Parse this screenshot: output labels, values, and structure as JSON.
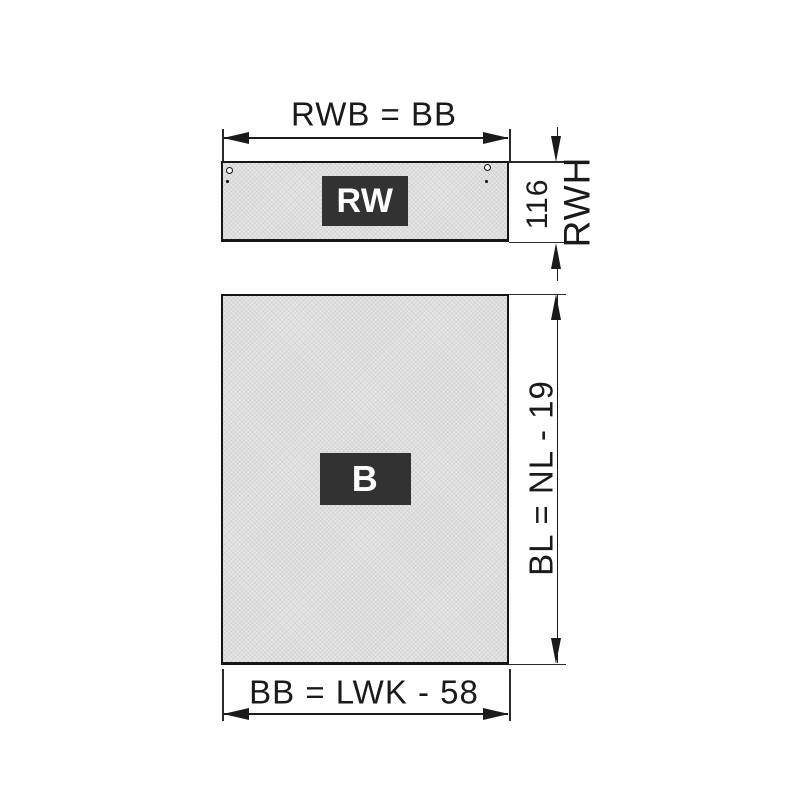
{
  "panels": {
    "rear_wall": {
      "label": "RW"
    },
    "bottom_panel": {
      "label": "B"
    }
  },
  "dimensions": {
    "top_width": {
      "label": "RWB = BB"
    },
    "rear_wall_height": {
      "value": "116",
      "label": "RWH"
    },
    "bottom_length": {
      "label": "BL = NL - 19"
    },
    "bottom_width": {
      "label": "BB = LWK - 58"
    }
  },
  "colors": {
    "background": "#ffffff",
    "line": "#1a1a1a",
    "panel_fill": "#e6e6e6",
    "panel_border": "#161616",
    "label_box_bg": "#323232",
    "label_text": "#ffffff"
  }
}
